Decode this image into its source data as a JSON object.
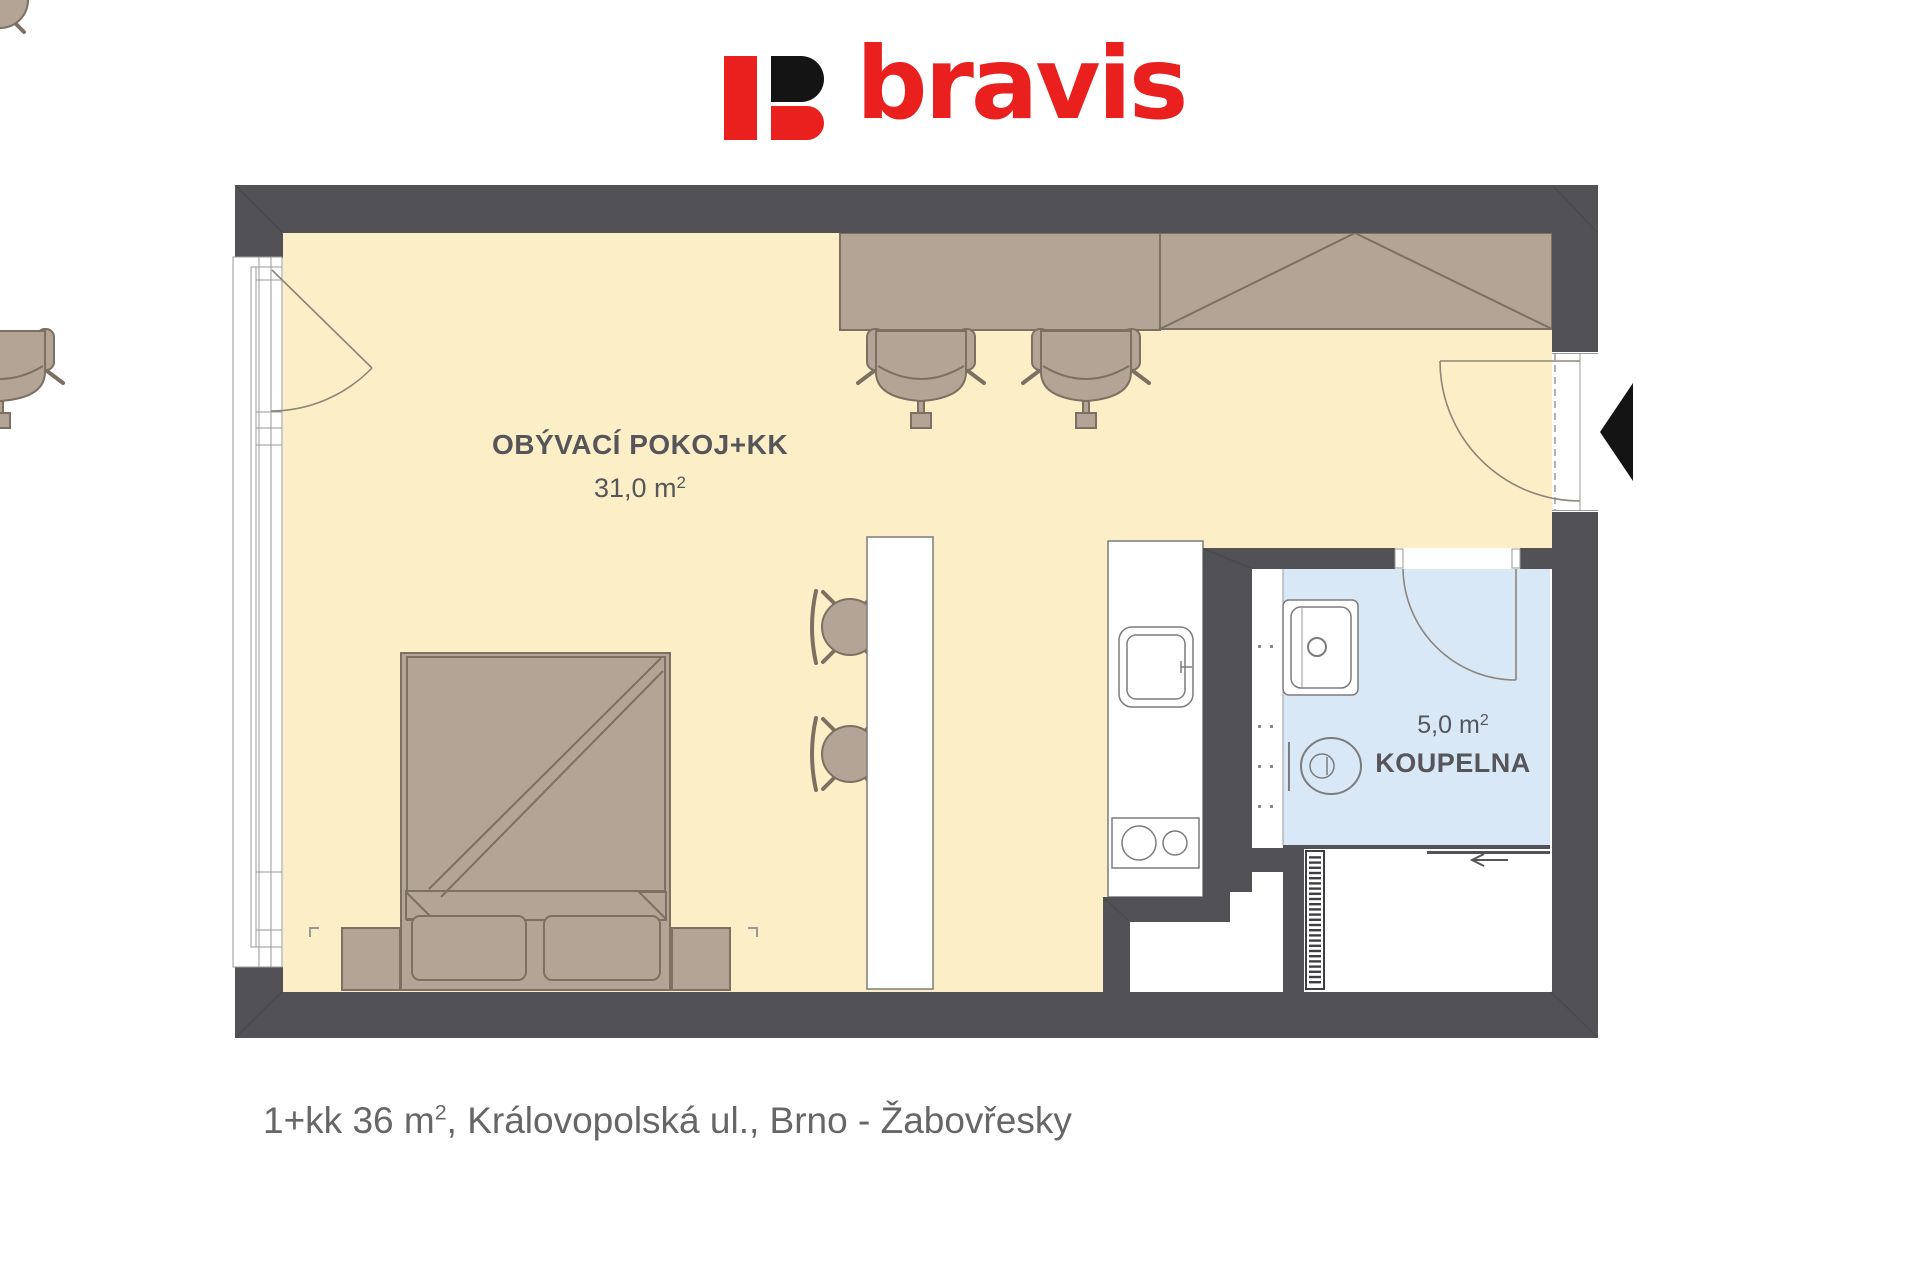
{
  "logo": {
    "text": "bravis"
  },
  "rooms": {
    "living": {
      "name": "OBÝVACÍ POKOJ+KK",
      "area": "31,0 m",
      "area_sup": "2"
    },
    "bathroom": {
      "name": "KOUPELNA",
      "area": "5,0 m",
      "area_sup": "2"
    }
  },
  "caption": {
    "part1": "1+kk 36 m",
    "sup": "2",
    "part2": ", Královopolská ul., Brno - Žabovřesky"
  },
  "colors": {
    "wall": "#525156",
    "floor": "#fcefc7",
    "bath": "#d8e8f7",
    "furn": "#b4a495",
    "furnline": "#7b7061",
    "line": "#7c7c7c",
    "red": "#e9201d",
    "black": "#141414",
    "label": "#56555a",
    "caption": "#666666"
  }
}
